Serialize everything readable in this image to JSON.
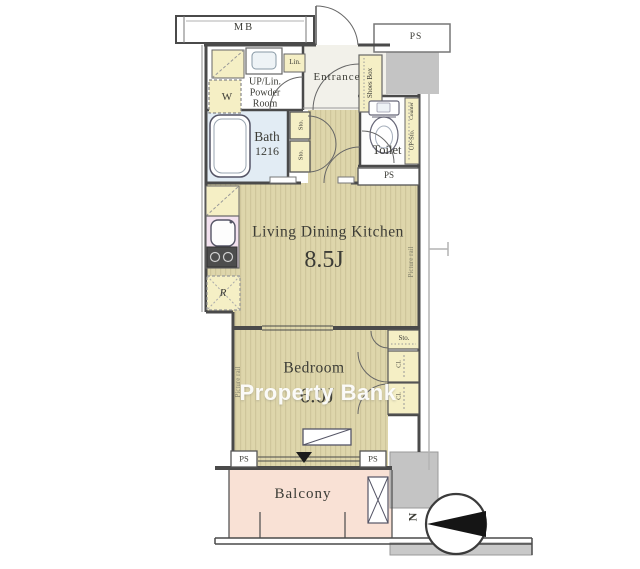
{
  "plan": {
    "service": {
      "mb": "MB",
      "ps_top": "PS",
      "ps_toilet": "PS",
      "ps_bottom_left": "PS",
      "ps_bottom_right": "PS"
    },
    "rooms": {
      "powder_room": {
        "line1": "UP/Lin.",
        "line2": "Powder",
        "line3": "Room"
      },
      "laundry": {
        "washer": "W"
      },
      "entrance": {
        "name": "Entrance",
        "shoes_box": "Shoes Box",
        "linen": "Lin."
      },
      "bath": {
        "name": "Bath",
        "size": "1216"
      },
      "toilet": {
        "name": "Toilet",
        "counter": "Counter",
        "storage": "UP-Sto."
      },
      "ldk": {
        "name": "Living Dining Kitchen",
        "size": "8.5J",
        "picture_rail": "Picture rail",
        "fridge": "R"
      },
      "bedroom": {
        "name": "Bedroom",
        "size": "6.0J",
        "picture_rail": "Picture rail"
      },
      "balcony": {
        "name": "Balcony"
      }
    },
    "storage": {
      "hall_sto_1": "Sto.",
      "hall_sto_2": "Sto.",
      "closet_sto": "Sto.",
      "closet_cl_1": "Cl.",
      "closet_cl_2": "Cl."
    },
    "compass": {
      "north": "N"
    }
  },
  "watermark": {
    "text": "Property Bank"
  },
  "colors": {
    "floor": "#ded6ab",
    "floor_stripe": "#cfc69b",
    "balcony_floor": "#f9e1d5",
    "bath_floor": "#e2ecf4",
    "storage_fill": "#f5efc5",
    "kitchen_counter": "#f3e2ef",
    "wall": "#4a4a4a",
    "concrete_fill": "#c4c4c4",
    "watermark_text": "#ffffff"
  }
}
